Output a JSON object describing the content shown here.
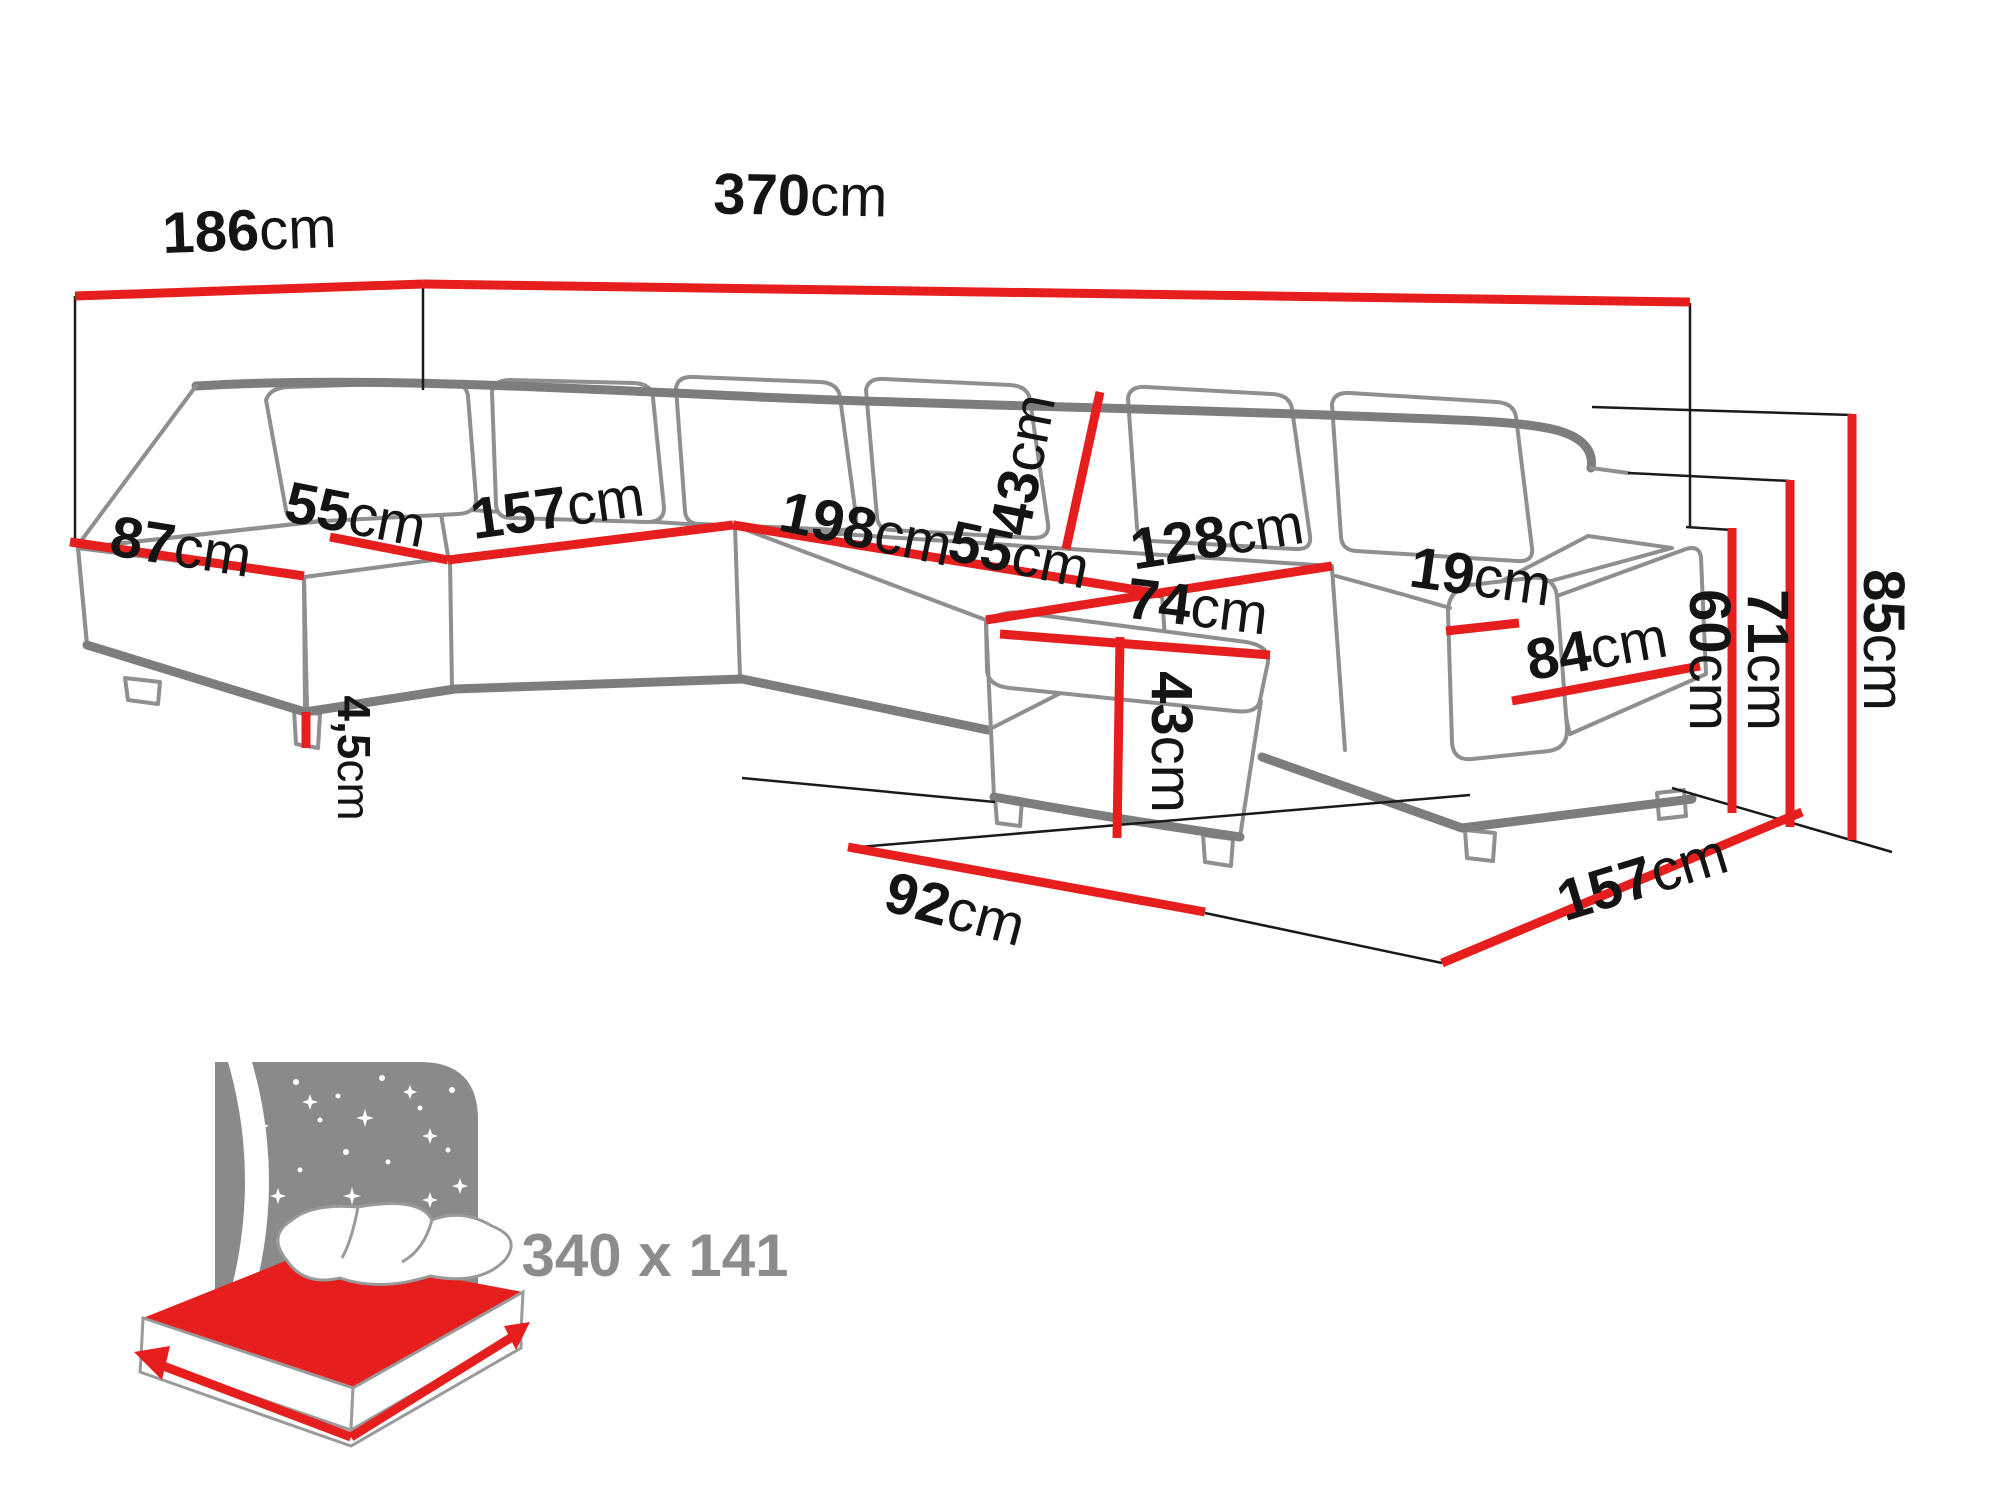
{
  "diagram": {
    "title": "corner-sofa-dimension-drawing",
    "colors": {
      "dimension_line": "#e61e1e",
      "sofa_outline": "#8f8f8f",
      "sofa_outline_dark": "#7d7d7d",
      "label_text": "#141414",
      "icon_grey": "#8c8c8c"
    },
    "dims": {
      "d186": {
        "num": "186",
        "unit": "cm"
      },
      "d370": {
        "num": "370",
        "unit": "cm"
      },
      "d87": {
        "num": "87",
        "unit": "cm"
      },
      "d55a": {
        "num": "55",
        "unit": "cm"
      },
      "d157a": {
        "num": "157",
        "unit": "cm"
      },
      "d198": {
        "num": "198",
        "unit": "cm"
      },
      "d55b": {
        "num": "55",
        "unit": "cm"
      },
      "d43back": {
        "num": "43",
        "unit": "cm"
      },
      "d128": {
        "num": "128",
        "unit": "cm"
      },
      "d74": {
        "num": "74",
        "unit": "cm"
      },
      "d19": {
        "num": "19",
        "unit": "cm"
      },
      "d84": {
        "num": "84",
        "unit": "cm"
      },
      "d43front": {
        "num": "43",
        "unit": "cm"
      },
      "d45": {
        "num": "4,5",
        "unit": "cm"
      },
      "d92": {
        "num": "92",
        "unit": "cm"
      },
      "d157b": {
        "num": "157",
        "unit": "cm"
      },
      "d60": {
        "num": "60",
        "unit": "cm"
      },
      "d71": {
        "num": "71",
        "unit": "cm"
      },
      "d85": {
        "num": "85",
        "unit": "cm"
      }
    },
    "bed_icon": {
      "size_label": "340 x 141"
    }
  }
}
